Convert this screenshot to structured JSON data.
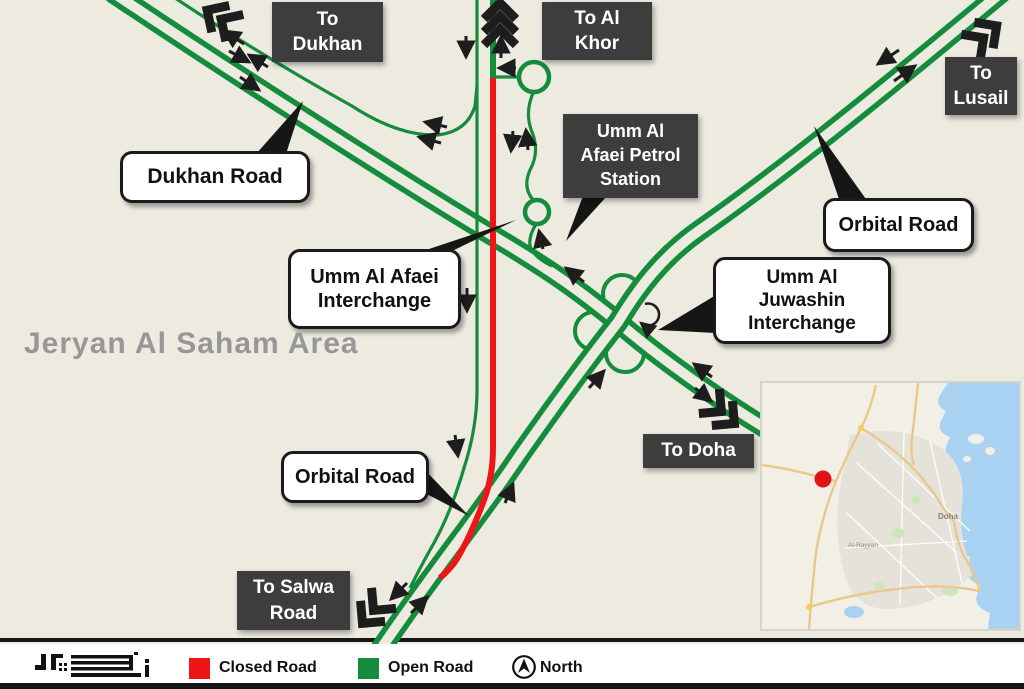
{
  "area_label": "Jeryan Al Saham Area",
  "destinations": {
    "dukhan": [
      "To",
      "Dukhan"
    ],
    "al_khor": [
      "To Al",
      "Khor"
    ],
    "lusail": [
      "To",
      "Lusail"
    ],
    "doha": [
      "To Doha"
    ],
    "salwa": [
      "To Salwa",
      "Road"
    ]
  },
  "places": {
    "petrol_station": [
      "Umm Al",
      "Afaei Petrol",
      "Station"
    ]
  },
  "road_labels": {
    "dukhan_road": [
      "Dukhan Road"
    ],
    "afaei_interchange": [
      "Umm Al Afaei",
      "Interchange"
    ],
    "juwashin_interchange": [
      "Umm Al",
      "Juwashin",
      "Interchange"
    ],
    "orbital_road_ne": [
      "Orbital Road"
    ],
    "orbital_road_sw": [
      "Orbital Road"
    ]
  },
  "legend": {
    "closed_label": "Closed Road",
    "open_label": "Open Road",
    "north_label": "North"
  },
  "inset": {
    "city_labels": [
      "Doha",
      "Al-Rayyan"
    ]
  },
  "colors": {
    "closed_road": "#ee1515",
    "open_road": "#148c3c",
    "background": "#edeae0",
    "label_box": "#3d3d3d"
  }
}
